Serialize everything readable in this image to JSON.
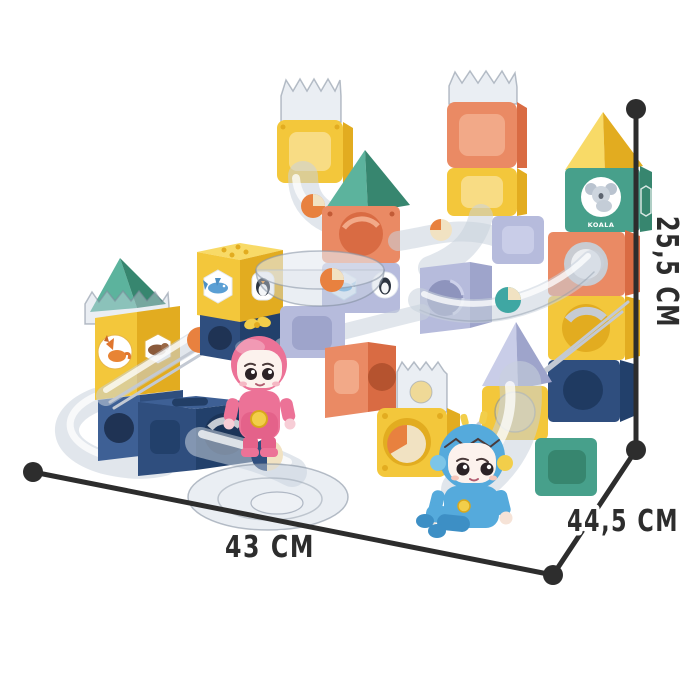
{
  "annotations": {
    "width_label": "43 CM",
    "depth_label": "44,5 CM",
    "height_label": "25,5 CM"
  },
  "badges": {
    "koala_label": "KOALA",
    "icons": [
      "fox",
      "walrus",
      "shark",
      "penguin",
      "whale",
      "koala"
    ]
  },
  "figures": [
    {
      "name": "pink-figure"
    },
    {
      "name": "blue-figure"
    }
  ],
  "colors": {
    "annotation": "#2d2d2d",
    "yellow": "#f3c73b",
    "yellow_dark": "#e2ac20",
    "yellow_light": "#f8da67",
    "orange": "#ea8a64",
    "orange_dark": "#d96b43",
    "orange_light": "#f2a988",
    "navy": "#2f4e7e",
    "navy_dark": "#22406b",
    "navy_light": "#3e6095",
    "lavender": "#b6bbdc",
    "lavender_dark": "#9ea4cb",
    "lavender_light": "#c9cde8",
    "teal": "#47a08b",
    "teal_dark": "#37866f",
    "teal_light": "#5cb39d",
    "pink": "#ec7297",
    "pink_dark": "#e4628a",
    "blue_figure": "#55aadc",
    "blue_figure_dark": "#3d8fc5",
    "accent_yellow": "#f2ce4a",
    "silver": "#c3c9d3",
    "ball_orange": "#e8813f",
    "ball_cream": "#f1e2c2",
    "ball_teal": "#3fa7a3"
  }
}
